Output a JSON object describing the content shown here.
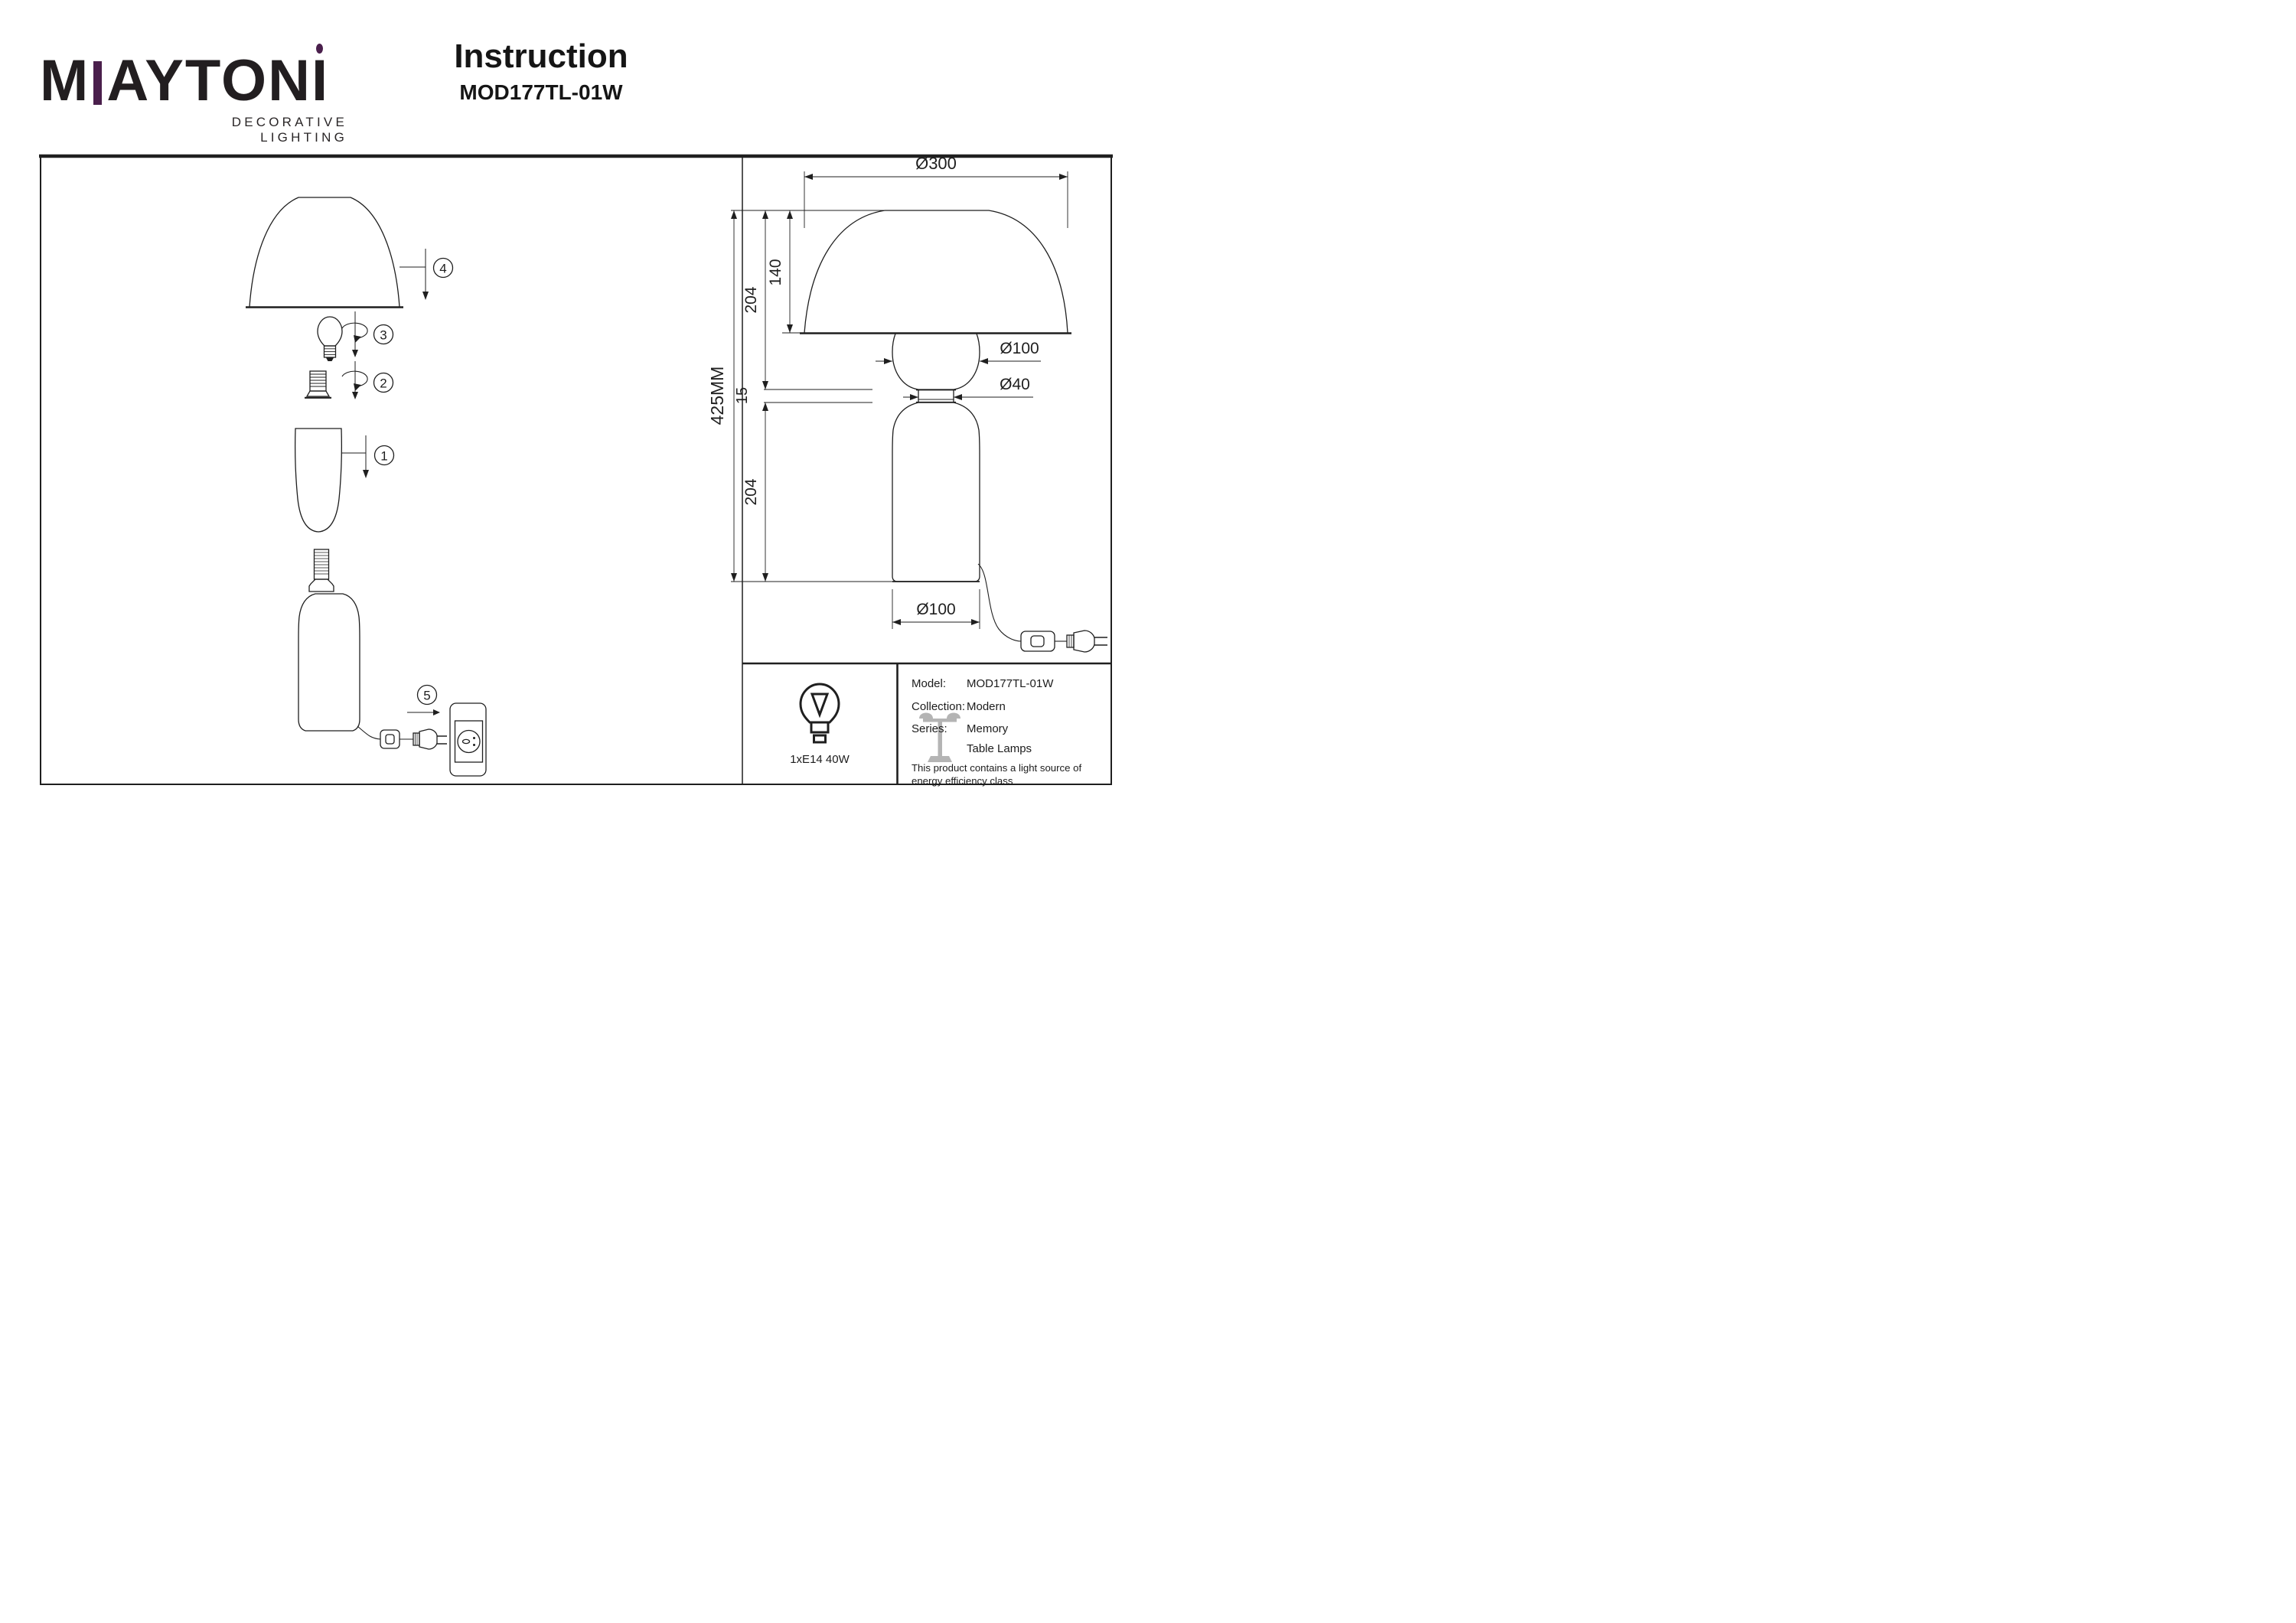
{
  "header": {
    "logo_text_m": "M",
    "logo_text_rest": "AYTON",
    "logo_text_last": "I",
    "logo_tagline": "DECORATIVE LIGHTING",
    "title": "Instruction",
    "model": "MOD177TL-01W"
  },
  "colors": {
    "accent_purple": "#4a1f4c",
    "line": "#1f1f1f",
    "watermark_gray": "#b4b4b4"
  },
  "assembly_steps": [
    "1",
    "2",
    "3",
    "4",
    "5"
  ],
  "dimensions": {
    "overall_height": "425MM",
    "shade_diameter": "Ø300",
    "shade_height": "140",
    "upper_section": "204",
    "ring_height": "15",
    "lower_section": "204",
    "glass_diameter": "Ø100",
    "neck_diameter": "Ø40",
    "base_diameter": "Ø100"
  },
  "spec_table": {
    "lamp_label": "1xE14 40W",
    "model_label": "Model:",
    "model_value": "MOD177TL-01W",
    "collection_label": "Collection:",
    "collection_value": "Modern",
    "series_label": "Series:",
    "series_value": "Memory",
    "series_value2": "Table Lamps",
    "note_line1": "This product contains a light source of",
    "note_line2": "energy efficiency class"
  }
}
